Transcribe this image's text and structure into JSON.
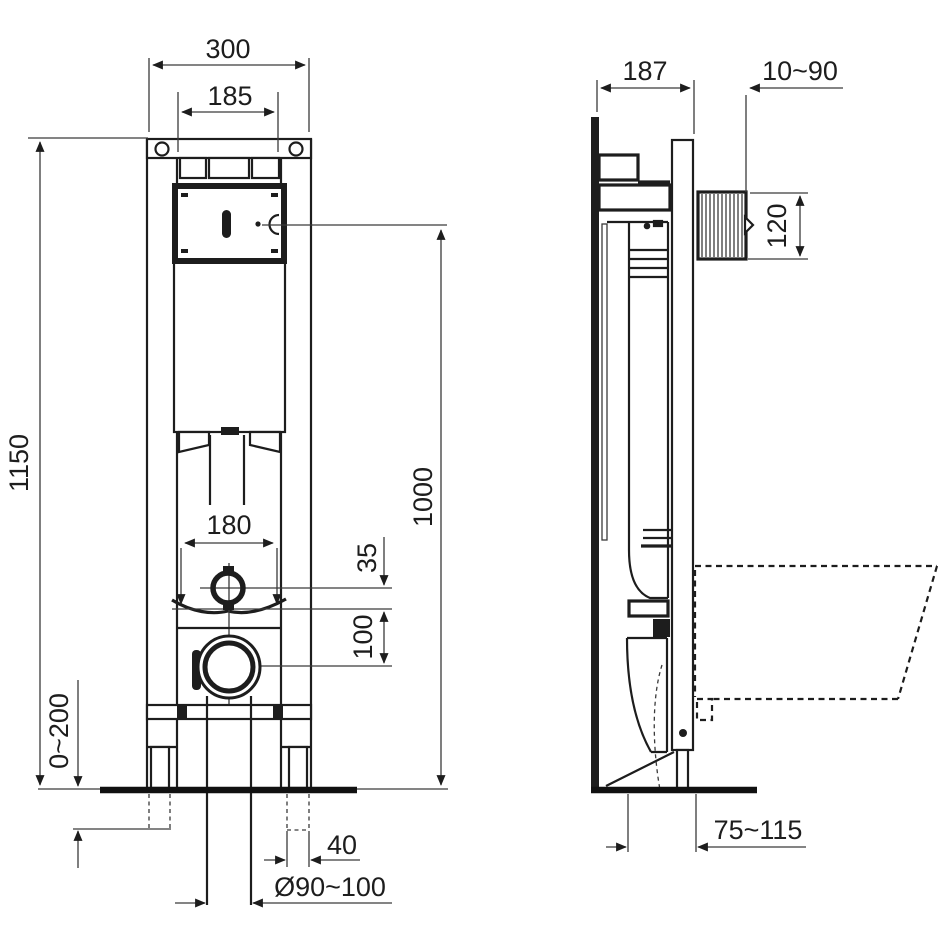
{
  "drawing": {
    "type": "technical-installation-diagram",
    "subject": "wall-hung-wc-concealed-cistern-frame",
    "views": {
      "front": "front-view",
      "side": "side-view"
    },
    "front": {
      "overall_width": "300",
      "cistern_width": "185",
      "overall_height": "1150",
      "flush_plate_height": "1000",
      "fixing_centres": "180",
      "inlet_offset": "35",
      "outlet_offset": "100",
      "leg_adjustment": "0~200",
      "outlet_stub_width": "40",
      "outlet_pipe_diameter": "Ø90~100"
    },
    "side": {
      "frame_depth": "187",
      "wall_finish_range": "10~90",
      "flush_bend_height": "120",
      "floor_outlet_distance": "75~115"
    },
    "colors": {
      "line": "#1d1d1d",
      "background": "#ffffff"
    }
  }
}
